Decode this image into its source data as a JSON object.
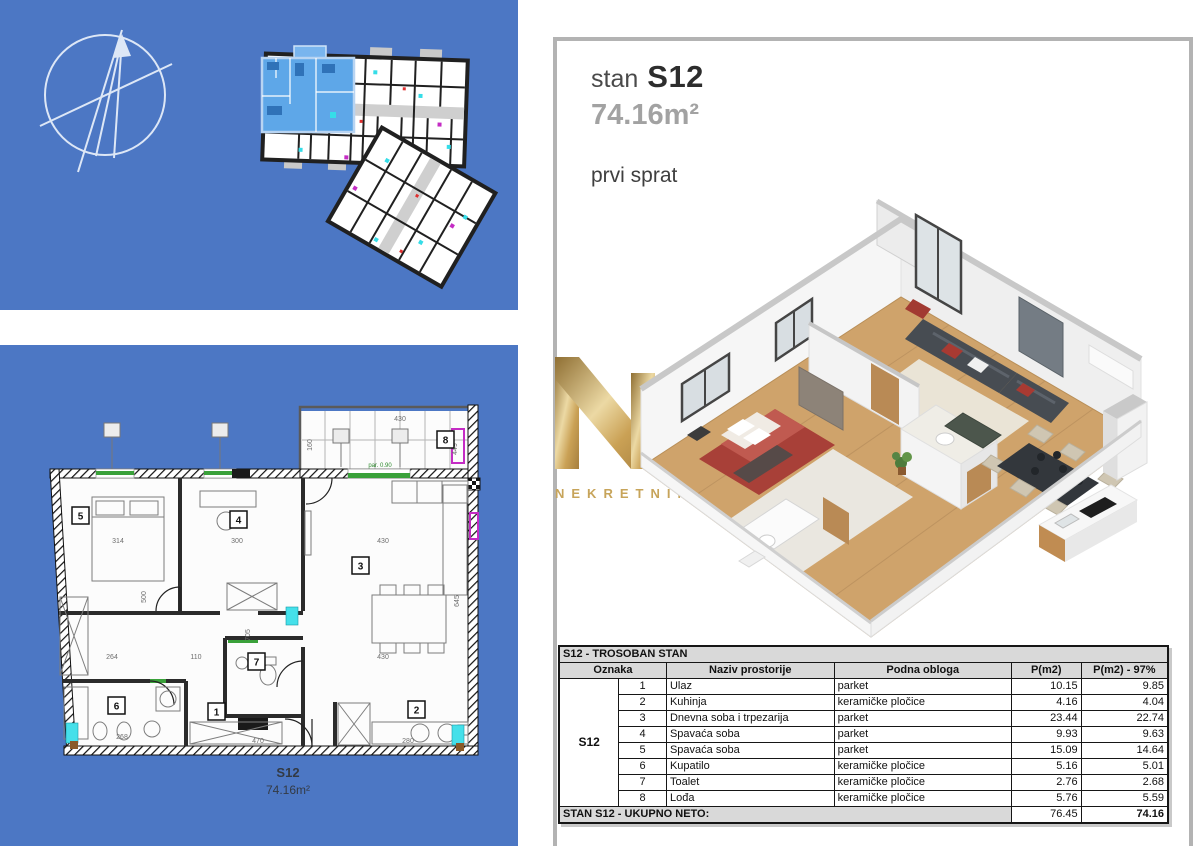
{
  "colors": {
    "panel_blue": "#4c77c4",
    "unit_highlight_blue": "#5ea7e8",
    "watermark_gold": "#c7a45a",
    "table_header_gray": "#d9d9d9",
    "panel_border_gray": "#b3b3b3",
    "area_text_gray": "#a2a2a2"
  },
  "plan_panel": {
    "rooms": [
      "1",
      "2",
      "3",
      "4",
      "5",
      "6",
      "7",
      "8"
    ],
    "dims": [
      "314",
      "300",
      "430",
      "264",
      "110",
      "580",
      "430",
      "268",
      "470",
      "280",
      "500",
      "705",
      "645",
      "430",
      "160",
      "449",
      "par. 0.90"
    ],
    "caption_code": "S12",
    "caption_area": "74.16m²"
  },
  "detail_panel": {
    "title_prefix": "stan",
    "title_code": "S12",
    "area": "74.16m²",
    "floor_label": "prvi sprat",
    "watermark_text": "NEKRETNINE",
    "table": {
      "title": "S12 - TROSOBAN STAN",
      "columns": [
        "Oznaka",
        "Naziv prostorije",
        "Podna obloga",
        "P(m2)",
        "P(m2) - 97%"
      ],
      "group_label": "S12",
      "rows": [
        {
          "num": "1",
          "name": "Ulaz",
          "floor": "parket",
          "area": "10.15",
          "area97": "9.85"
        },
        {
          "num": "2",
          "name": "Kuhinja",
          "floor": "keramičke pločice",
          "area": "4.16",
          "area97": "4.04"
        },
        {
          "num": "3",
          "name": "Dnevna soba i trpezarija",
          "floor": "parket",
          "area": "23.44",
          "area97": "22.74"
        },
        {
          "num": "4",
          "name": "Spavaća soba",
          "floor": "parket",
          "area": "9.93",
          "area97": "9.63"
        },
        {
          "num": "5",
          "name": "Spavaća soba",
          "floor": "parket",
          "area": "15.09",
          "area97": "14.64"
        },
        {
          "num": "6",
          "name": "Kupatilo",
          "floor": "keramičke pločice",
          "area": "5.16",
          "area97": "5.01"
        },
        {
          "num": "7",
          "name": "Toalet",
          "floor": "keramičke pločice",
          "area": "2.76",
          "area97": "2.68"
        },
        {
          "num": "8",
          "name": "Lođa",
          "floor": "keramičke pločice",
          "area": "5.76",
          "area97": "5.59"
        }
      ],
      "footer_label": "STAN S12 - UKUPNO NETO:",
      "footer_total": "76.45",
      "footer_total_97": "74.16"
    }
  }
}
